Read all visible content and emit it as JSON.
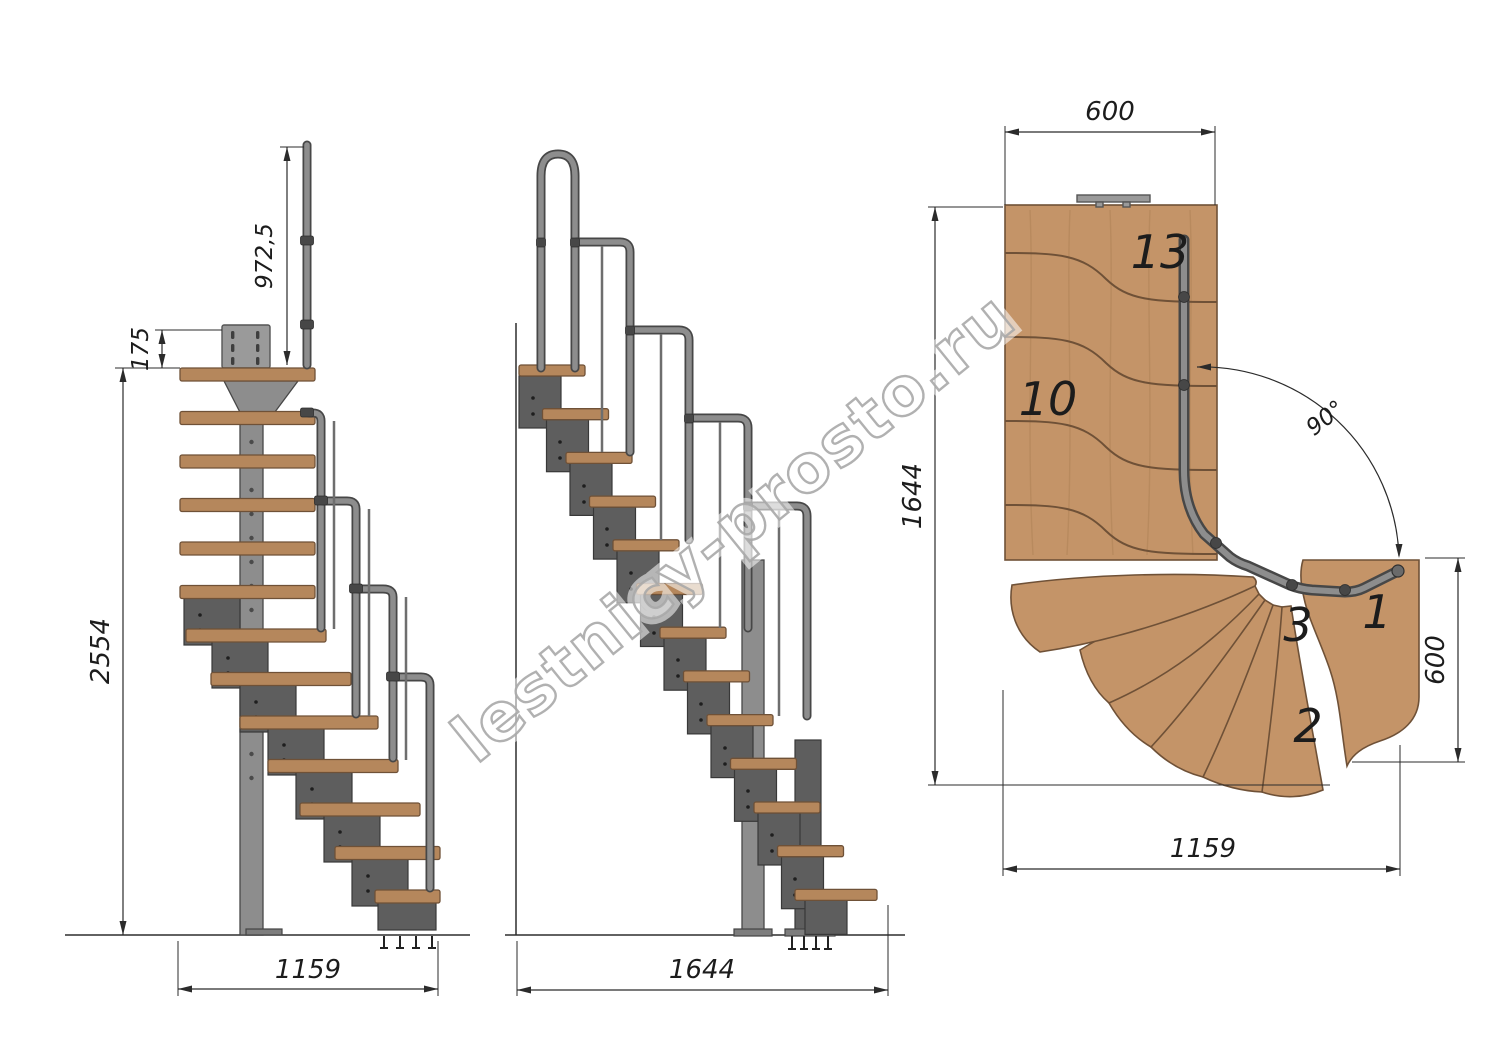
{
  "watermark": {
    "text": "lestnicy-prosto.ru"
  },
  "front_view": {
    "dim_total_height": "2554",
    "dim_rail_height": "972,5",
    "dim_top_offset": "175",
    "dim_width": "1159"
  },
  "side_view": {
    "dim_length": "1644"
  },
  "plan_view": {
    "dim_top": "600",
    "dim_left": "1644",
    "dim_right": "600",
    "dim_bottom": "1159",
    "dim_angle": "90°",
    "steps": {
      "s13": "13",
      "s10": "10",
      "s3": "3",
      "s1": "1",
      "s2": "2"
    }
  },
  "colors": {
    "wood": "#c49468",
    "wood_edge": "#6f5137",
    "wood_side": "#b5875c",
    "steel_light": "#8d8d8d",
    "steel_mid": "#6e6e6e",
    "steel_dark": "#474747",
    "module": "#5e5e5e",
    "module_edge": "#383838",
    "line": "#2b2b2b",
    "text": "#1c1c1c",
    "watermark_stroke": "#a9a9a9",
    "grain": "#a3794e"
  }
}
